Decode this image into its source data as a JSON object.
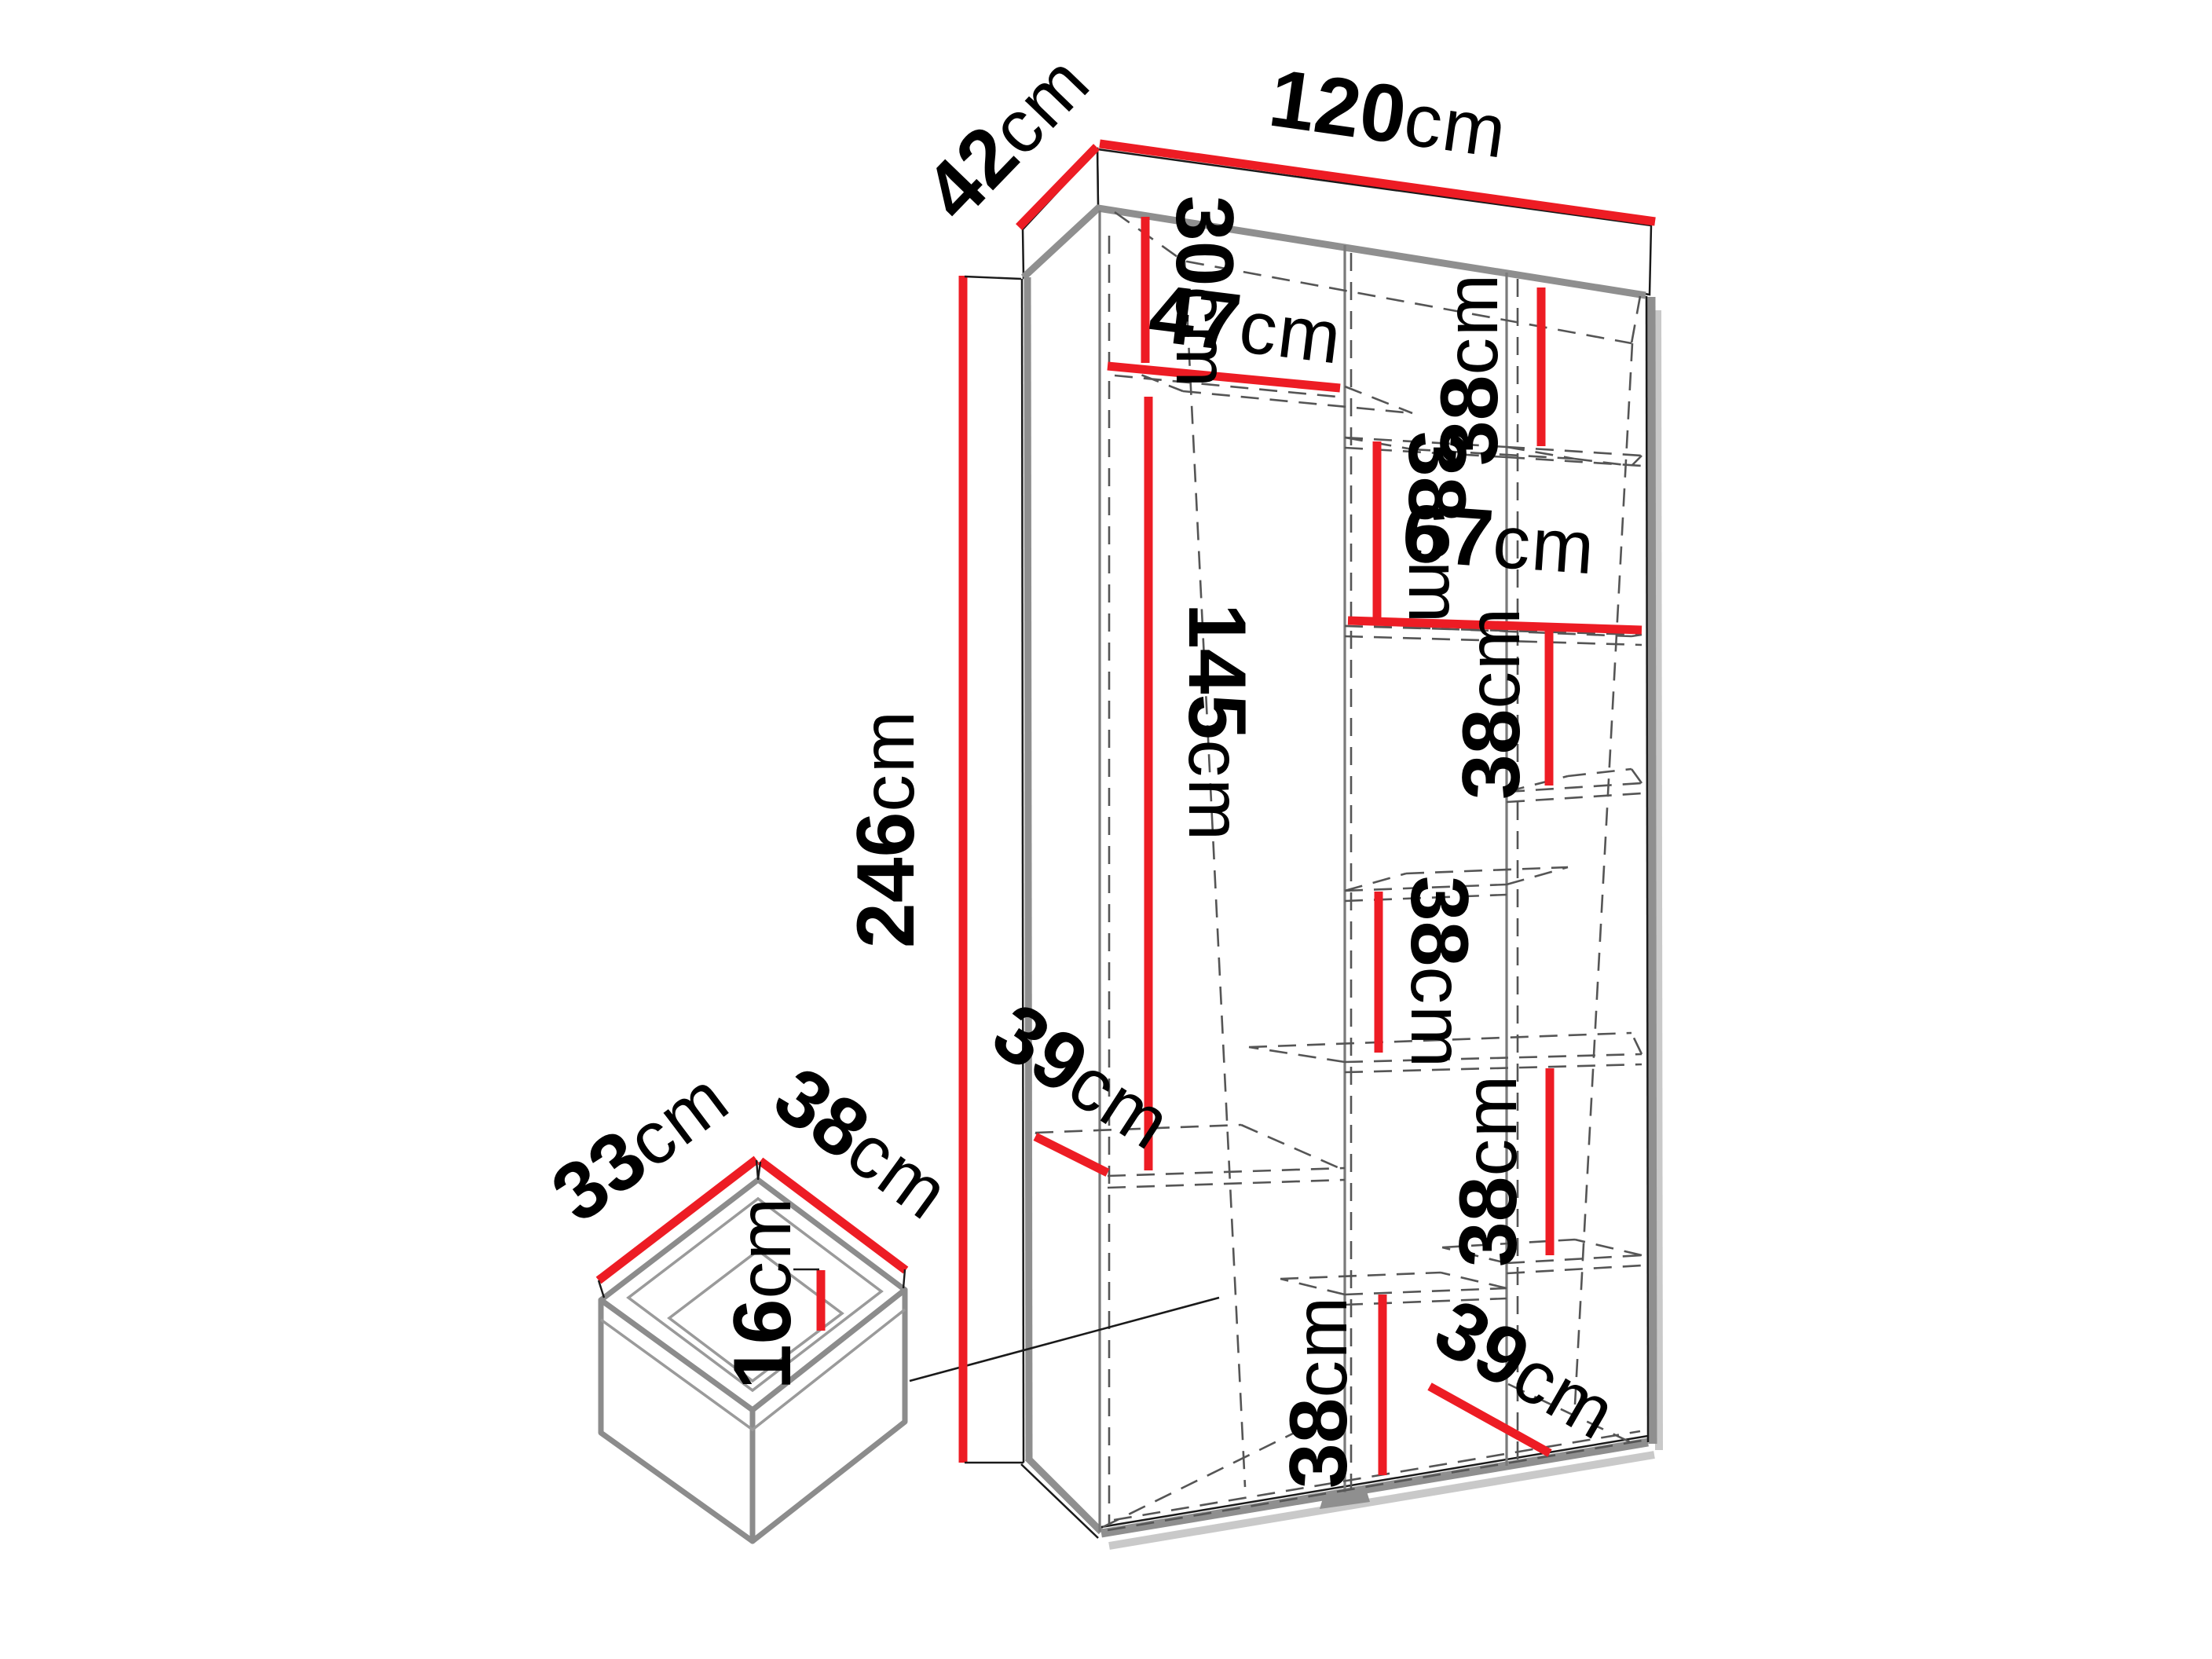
{
  "diagram": {
    "kind": "furniture-dimension-diagram",
    "item": "tall wardrobe with internal shelves and a drawer",
    "colors": {
      "dimension_line": "#ed1c24",
      "outline": "#8f8f8f",
      "hidden_line": "#555555",
      "text": "#000000",
      "background": "#ffffff"
    },
    "wardrobe": {
      "width_cm": 120,
      "depth_cm": 42,
      "height_cm": 246,
      "top_compartment_height_cm": 30,
      "left_column_width_cm": 47,
      "hanging_space_height_cm": 145,
      "shelf_gap_cm": 38,
      "shelf_depth_cm": 39,
      "lower_span_width_cm": 67,
      "bottom_gap_cm": 38
    },
    "drawer": {
      "inner_depth_cm": 33,
      "inner_width_cm": 38,
      "inner_height_cm": 16
    }
  },
  "labels": {
    "depth": {
      "v": "42",
      "u": "cm"
    },
    "width": {
      "v": "120",
      "u": "cm"
    },
    "top": {
      "v": "30",
      "u": "cm"
    },
    "left_w": {
      "v": "47",
      "u": "cm"
    },
    "r38a": {
      "v": "38",
      "u": "cm"
    },
    "m38a": {
      "v": "38",
      "u": "cm"
    },
    "span": {
      "v": "67",
      "u": "cm"
    },
    "hang": {
      "v": "145",
      "u": "cm"
    },
    "height": {
      "v": "246",
      "u": "cm"
    },
    "r38b": {
      "v": "38",
      "u": "cm"
    },
    "m38b": {
      "v": "38",
      "u": "cm"
    },
    "r38c": {
      "v": "38",
      "u": "cm"
    },
    "depth_l": {
      "v": "39",
      "u": "cm"
    },
    "bottom": {
      "v": "38",
      "u": "cm"
    },
    "depth_r": {
      "v": "39",
      "u": "cm"
    },
    "dw_d": {
      "v": "33",
      "u": "cm"
    },
    "dw_w": {
      "v": "38",
      "u": "cm"
    },
    "dw_h": {
      "v": "16",
      "u": "cm"
    }
  }
}
